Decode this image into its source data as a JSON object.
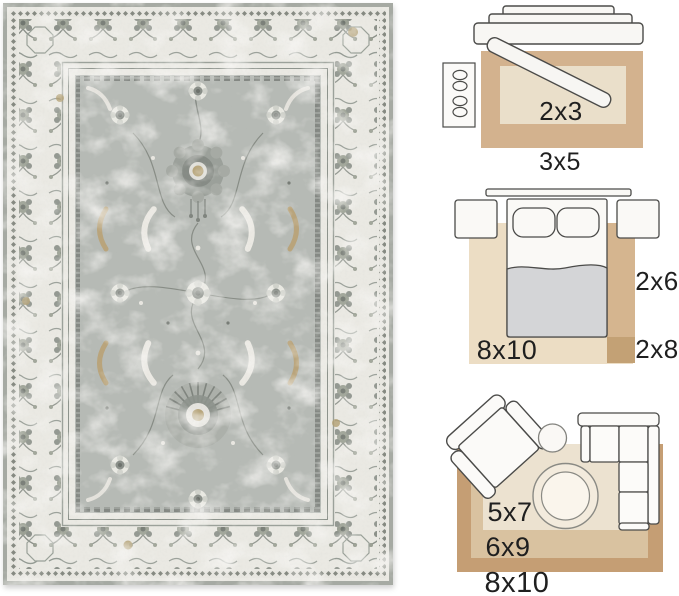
{
  "image_type": "rug product photo with room size-guide diagrams",
  "rug_photo": {
    "description": "distressed vintage oriental area rug, gray floral field with ivory ornate border",
    "colors": {
      "binding": "#a6aaa3",
      "border_ivory": "#eae9e3",
      "field_gray": "#b6bab5",
      "motif_dark": "#7d827d",
      "motif_light": "#ebe9e3",
      "accent_tan": "#b3a073"
    }
  },
  "size_guide": {
    "text_color": "#1f1f1f",
    "furniture_outline": "#4b4b49",
    "entryway": {
      "furniture": [
        "console-table",
        "entry-door-leaf",
        "shoe-cabinet"
      ],
      "outer_rug": {
        "label": "3x5",
        "color": "#d3b28e"
      },
      "inner_rug": {
        "label": "2x3",
        "color": "#eadfca"
      }
    },
    "bedroom": {
      "furniture": [
        "headboard",
        "nightstand-left",
        "nightstand-right",
        "bed",
        "pillow",
        "pillow",
        "blanket"
      ],
      "area_rug": {
        "label": "8x10",
        "color": "#ecddc4"
      },
      "runner": {
        "label": "2x6",
        "color": "#d5b58f"
      },
      "runner_extension": {
        "label": "2x8",
        "color": "#c3a175"
      }
    },
    "living_room": {
      "furniture": [
        "armchair",
        "side-table",
        "round-coffee-table",
        "sectional-sofa"
      ],
      "outer_rug": {
        "label": "8x10",
        "color": "#c59e74"
      },
      "middle_rug": {
        "label": "6x9",
        "color": "#d9c2a0"
      },
      "inner_rug": {
        "label": "5x7",
        "color": "#ece2d0"
      }
    }
  }
}
